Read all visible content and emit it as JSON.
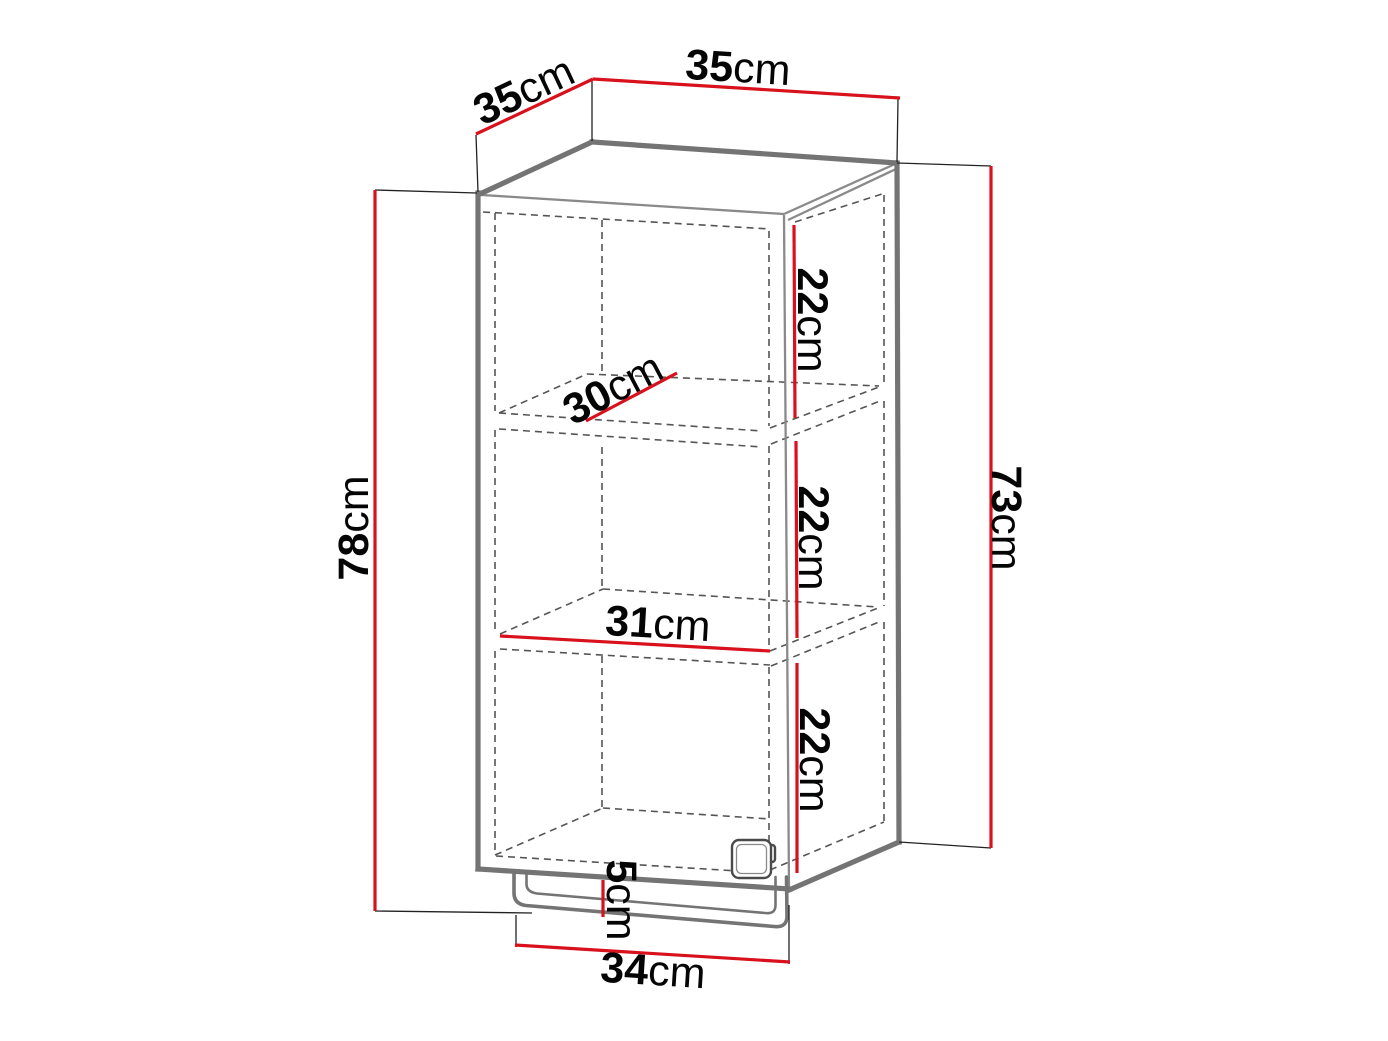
{
  "colors": {
    "dimension": "#d8111c",
    "edge": "#747474",
    "edge_light": "#8a8a8a",
    "hidden": "#555555",
    "extension": "#222222",
    "label": "#050505",
    "background": "#ffffff"
  },
  "dimensions": {
    "depth_top": {
      "value": "35",
      "unit": "cm"
    },
    "width_top": {
      "value": "35",
      "unit": "cm"
    },
    "height_total": {
      "value": "78",
      "unit": "cm"
    },
    "height_carcass": {
      "value": "73",
      "unit": "cm"
    },
    "gap_top": {
      "value": "22",
      "unit": "cm"
    },
    "gap_middle": {
      "value": "22",
      "unit": "cm"
    },
    "gap_bottom": {
      "value": "22",
      "unit": "cm"
    },
    "shelf_depth": {
      "value": "30",
      "unit": "cm"
    },
    "shelf_width": {
      "value": "31",
      "unit": "cm"
    },
    "rail_offset": {
      "value": "5",
      "unit": "cm"
    },
    "rail_width": {
      "value": "34",
      "unit": "cm"
    }
  }
}
